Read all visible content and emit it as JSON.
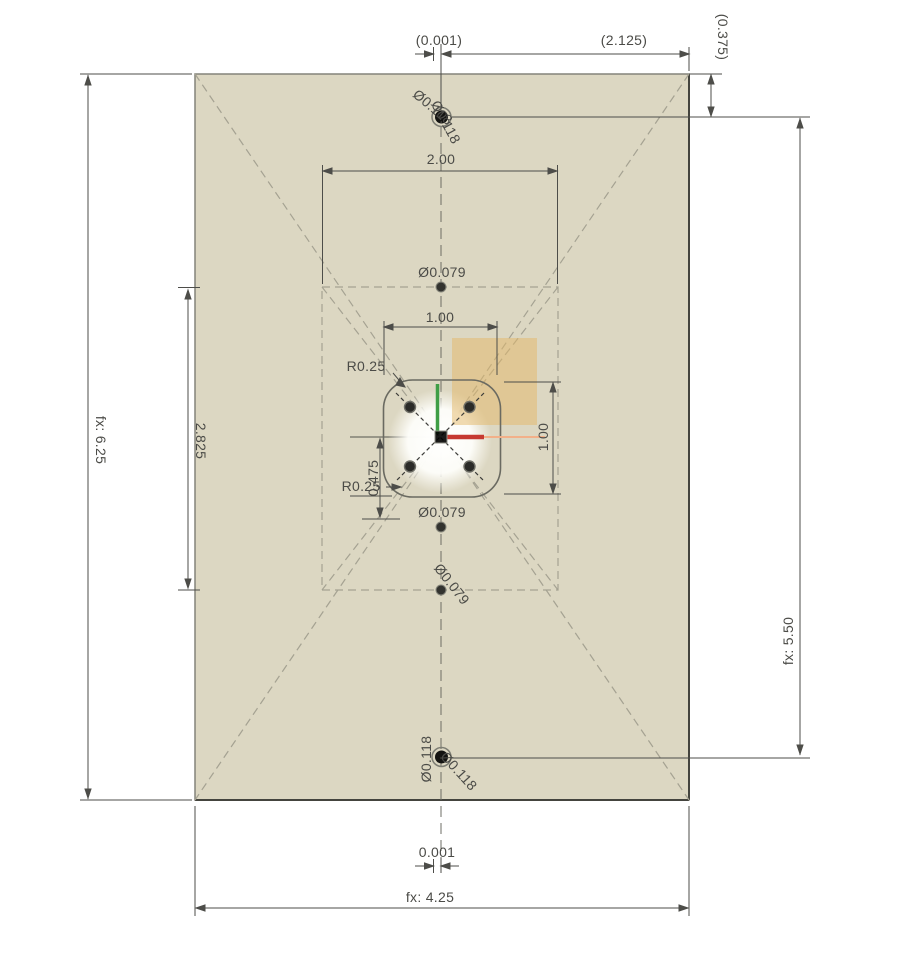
{
  "view": {
    "type": "cad-sketch-drawing",
    "canvas_width": 914,
    "canvas_height": 963
  },
  "colors": {
    "background": "#ffffff",
    "plate_fill": "#dcd7c2",
    "plate_border": "#7c7c70",
    "construction_line": "#a5a292",
    "dimension_line": "#4d4d49",
    "dimension_text": "#4b4b47",
    "highlight_fill": "#e3b868",
    "axis_x_red": "#c63931",
    "axis_x_extension_orange": "#f2b089",
    "axis_y_green": "#3f9e46",
    "hole_fill": "#1c1c1a"
  },
  "dims": {
    "top_offset": "(0.001)",
    "top_span": "(2.125)",
    "top_edge_offset": "(0.375)",
    "rect_width": "2.00",
    "hole_dia_small_top": "Ø0.079",
    "square_width": "1.00",
    "corner_radius_top": "R0.25",
    "square_height": "1.00",
    "corner_radius_bottom": "R0.25",
    "center_offset": "0.475",
    "hole_dia_small_mid": "Ø0.079",
    "hole_dia_small_bottom": "Ø0.079",
    "inner_height": "2.825",
    "plate_height": "fx: 6.25",
    "hole_span_height": "fx: 5.50",
    "bottom_offset": "0.001",
    "plate_width": "fx: 4.25",
    "hole_dia_top_a": "Ø0.118",
    "hole_dia_top_b": "Ø0.118",
    "hole_dia_bottom_a": "Ø0.118",
    "hole_dia_bottom_b": "Ø0.118"
  }
}
